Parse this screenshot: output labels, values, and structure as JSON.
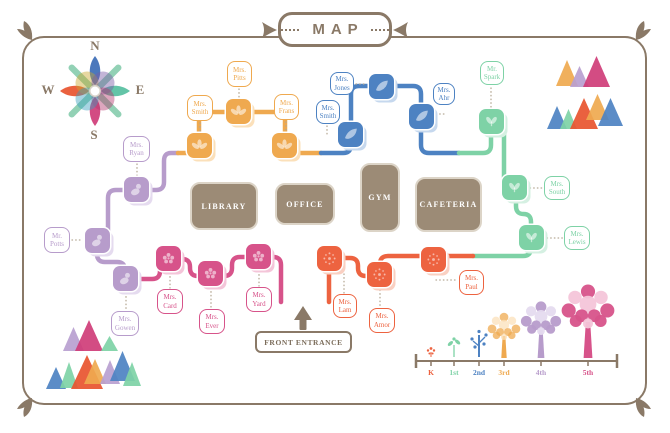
{
  "title": {
    "text": "MAP"
  },
  "compass": {
    "n": "N",
    "e": "E",
    "s": "S",
    "w": "W"
  },
  "front_entrance": {
    "label": "FRONT ENTRANCE"
  },
  "colors": {
    "frame": "#8a7967",
    "building": "#9c8b76",
    "building_border": "#dcd4c7",
    "dotted_connector": "#b5a894",
    "compass_arms": "#7fc9a8",
    "compass_petal_n": "#3c6db6",
    "compass_petal_e": "#56bfa0",
    "compass_petal_s": "#cf3d78",
    "compass_petal_w": "#e8542f"
  },
  "grades": {
    "K": {
      "color": "#ed6340",
      "light": "#fad0c2",
      "icon": "burst-icon"
    },
    "1st": {
      "color": "#7ed2a6",
      "light": "#d5f0e2",
      "icon": "sprout-icon"
    },
    "2nd": {
      "color": "#4d82c2",
      "light": "#c6d8ee",
      "icon": "leaf-icon"
    },
    "3rd": {
      "color": "#efa94f",
      "light": "#fbe0ba",
      "icon": "trefoil-icon"
    },
    "4th": {
      "color": "#b79ccb",
      "light": "#e5dbef",
      "icon": "person-icon"
    },
    "5th": {
      "color": "#d7538a",
      "light": "#f4c5d9",
      "icon": "flower-icon"
    }
  },
  "buildings": [
    {
      "id": "library",
      "label": "LIBRARY",
      "x": 190,
      "y": 182,
      "w": 68,
      "h": 48
    },
    {
      "id": "office",
      "label": "OFFICE",
      "x": 275,
      "y": 183,
      "w": 60,
      "h": 42
    },
    {
      "id": "gym",
      "label": "GYM",
      "x": 360,
      "y": 163,
      "w": 40,
      "h": 69
    },
    {
      "id": "cafeteria",
      "label": "CAFETERIA",
      "x": 415,
      "y": 177,
      "w": 67,
      "h": 55
    }
  ],
  "classrooms": [
    {
      "id": "ryan",
      "grade": "4th",
      "name": {
        "line1": "Mrs.",
        "line2": "Ryan"
      },
      "tile": {
        "x": 124,
        "y": 177
      },
      "box": {
        "x": 123,
        "y": 136,
        "w": 27,
        "h": 26
      },
      "conn": [
        137,
        164,
        137,
        176
      ]
    },
    {
      "id": "potts",
      "grade": "4th",
      "name": {
        "line1": "Mr.",
        "line2": "Potts"
      },
      "tile": {
        "x": 85,
        "y": 228
      },
      "box": {
        "x": 44,
        "y": 227,
        "w": 26,
        "h": 26
      },
      "conn": [
        72,
        240,
        83,
        240
      ]
    },
    {
      "id": "gowen",
      "grade": "4th",
      "name": {
        "line1": "Mrs.",
        "line2": "Gowen"
      },
      "tile": {
        "x": 113,
        "y": 266
      },
      "box": {
        "x": 111,
        "y": 311,
        "w": 28,
        "h": 25
      },
      "conn": [
        126,
        293,
        126,
        310
      ]
    },
    {
      "id": "card",
      "grade": "5th",
      "name": {
        "line1": "Mrs.",
        "line2": "Card"
      },
      "tile": {
        "x": 156,
        "y": 246
      },
      "box": {
        "x": 157,
        "y": 289,
        "w": 26,
        "h": 25
      },
      "conn": [
        170,
        273,
        170,
        288
      ]
    },
    {
      "id": "ever",
      "grade": "5th",
      "name": {
        "line1": "Mrs.",
        "line2": "Ever"
      },
      "tile": {
        "x": 198,
        "y": 261
      },
      "box": {
        "x": 199,
        "y": 309,
        "w": 26,
        "h": 25
      },
      "conn": [
        211,
        288,
        211,
        308
      ]
    },
    {
      "id": "yard",
      "grade": "5th",
      "name": {
        "line1": "Mrs.",
        "line2": "Yard"
      },
      "tile": {
        "x": 246,
        "y": 244
      },
      "box": {
        "x": 246,
        "y": 287,
        "w": 26,
        "h": 25
      },
      "conn": [
        259,
        271,
        259,
        286
      ]
    },
    {
      "id": "smith3",
      "grade": "3rd",
      "name": {
        "line1": "Mrs.",
        "line2": "Smith"
      },
      "tile": {
        "x": 187,
        "y": 133
      },
      "box": {
        "x": 187,
        "y": 95,
        "w": 26,
        "h": 26
      },
      "conn": [
        200,
        123,
        200,
        132
      ]
    },
    {
      "id": "pitts",
      "grade": "3rd",
      "name": {
        "line1": "Mrs.",
        "line2": "Pitts"
      },
      "tile": {
        "x": 226,
        "y": 99
      },
      "box": {
        "x": 227,
        "y": 61,
        "w": 25,
        "h": 26
      },
      "conn": [
        239,
        89,
        239,
        98
      ]
    },
    {
      "id": "frans",
      "grade": "3rd",
      "name": {
        "line1": "Mrs.",
        "line2": "Frans"
      },
      "tile": {
        "x": 272,
        "y": 133
      },
      "box": {
        "x": 274,
        "y": 94,
        "w": 25,
        "h": 26
      },
      "conn": [
        286,
        122,
        286,
        132
      ]
    },
    {
      "id": "jones",
      "grade": "2nd",
      "name": {
        "line1": "Mrs.",
        "line2": "Jones"
      },
      "tile": {
        "x": 369,
        "y": 74
      },
      "box": {
        "x": 330,
        "y": 72,
        "w": 24,
        "h": 23
      },
      "conn": [
        356,
        84,
        367,
        84
      ]
    },
    {
      "id": "smith2",
      "grade": "2nd",
      "name": {
        "line1": "Mrs.",
        "line2": "Smith"
      },
      "tile": {
        "x": 338,
        "y": 122
      },
      "box": {
        "x": 316,
        "y": 100,
        "w": 24,
        "h": 24
      },
      "conn": [
        327,
        126,
        327,
        137
      ]
    },
    {
      "id": "ahr",
      "grade": "2nd",
      "name": {
        "line1": "Mrs.",
        "line2": "Ahr"
      },
      "tile": {
        "x": 409,
        "y": 104
      },
      "box": {
        "x": 433,
        "y": 83,
        "w": 22,
        "h": 22
      },
      "conn": [
        436,
        114,
        446,
        114
      ]
    },
    {
      "id": "spark",
      "grade": "1st",
      "name": {
        "line1": "Mr.",
        "line2": "Spark"
      },
      "tile": {
        "x": 479,
        "y": 109
      },
      "box": {
        "x": 480,
        "y": 61,
        "w": 24,
        "h": 24
      },
      "conn": [
        491,
        88,
        491,
        107
      ]
    },
    {
      "id": "south",
      "grade": "1st",
      "name": {
        "line1": "Mrs.",
        "line2": "South"
      },
      "tile": {
        "x": 502,
        "y": 175
      },
      "box": {
        "x": 544,
        "y": 176,
        "w": 26,
        "h": 24
      },
      "conn": [
        530,
        188,
        543,
        188
      ]
    },
    {
      "id": "lewis",
      "grade": "1st",
      "name": {
        "line1": "Mrs.",
        "line2": "Lewis"
      },
      "tile": {
        "x": 519,
        "y": 225
      },
      "box": {
        "x": 564,
        "y": 226,
        "w": 26,
        "h": 24
      },
      "conn": [
        547,
        238,
        563,
        238
      ]
    },
    {
      "id": "lam",
      "grade": "K",
      "name": {
        "line1": "Mrs.",
        "line2": "Lam"
      },
      "tile": {
        "x": 317,
        "y": 246
      },
      "box": {
        "x": 333,
        "y": 294,
        "w": 24,
        "h": 24
      },
      "conn": [
        344,
        274,
        344,
        293
      ]
    },
    {
      "id": "amor",
      "grade": "K",
      "name": {
        "line1": "Mrs.",
        "line2": "Amor"
      },
      "tile": {
        "x": 367,
        "y": 262
      },
      "box": {
        "x": 369,
        "y": 308,
        "w": 26,
        "h": 25
      },
      "conn": [
        380,
        290,
        380,
        307
      ]
    },
    {
      "id": "paul",
      "grade": "K",
      "name": {
        "line1": "Mrs.",
        "line2": "Paul"
      },
      "tile": {
        "x": 421,
        "y": 247
      },
      "box": {
        "x": 459,
        "y": 270,
        "w": 25,
        "h": 25
      },
      "conn": [
        436,
        280,
        458,
        280
      ]
    }
  ],
  "legend": {
    "axis": {
      "x1": 416,
      "x2": 617,
      "y": 361
    },
    "items": [
      {
        "grade": "K",
        "label": "K",
        "x": 431,
        "type": "flower"
      },
      {
        "grade": "1st",
        "label": "1st",
        "x": 454,
        "type": "sprout"
      },
      {
        "grade": "2nd",
        "label": "2nd",
        "x": 479,
        "type": "sapling"
      },
      {
        "grade": "3rd",
        "label": "3rd",
        "x": 504,
        "type": "tree",
        "trunk": 22,
        "radius": 13
      },
      {
        "grade": "4th",
        "label": "4th",
        "x": 541,
        "type": "tree",
        "trunk": 28,
        "radius": 16
      },
      {
        "grade": "5th",
        "label": "5th",
        "x": 588,
        "type": "tree",
        "trunk": 36,
        "radius": 21
      }
    ]
  },
  "decorations": {
    "triangles_top_right": [
      {
        "x": 556,
        "y": 60,
        "w": 22,
        "h": 26,
        "c": "#efa94f"
      },
      {
        "x": 570,
        "y": 66,
        "w": 19,
        "h": 21,
        "c": "#b9a0d0"
      },
      {
        "x": 583,
        "y": 56,
        "w": 27,
        "h": 31,
        "c": "#cf3d78"
      },
      {
        "x": 547,
        "y": 106,
        "w": 20,
        "h": 23,
        "c": "#4d82c2"
      },
      {
        "x": 560,
        "y": 109,
        "w": 17,
        "h": 20,
        "c": "#7ed2a6"
      },
      {
        "x": 570,
        "y": 98,
        "w": 28,
        "h": 31,
        "c": "#e8542f"
      },
      {
        "x": 586,
        "y": 94,
        "w": 23,
        "h": 26,
        "c": "#efa94f"
      },
      {
        "x": 598,
        "y": 98,
        "w": 25,
        "h": 28,
        "c": "#4d82c2"
      }
    ],
    "triangles_bottom_left": [
      {
        "x": 63,
        "y": 327,
        "w": 21,
        "h": 24,
        "c": "#b9a0d0"
      },
      {
        "x": 75,
        "y": 320,
        "w": 28,
        "h": 31,
        "c": "#cf3d78"
      },
      {
        "x": 101,
        "y": 336,
        "w": 17,
        "h": 15,
        "c": "#7ed2a6"
      },
      {
        "x": 46,
        "y": 367,
        "w": 20,
        "h": 22,
        "c": "#4d82c2"
      },
      {
        "x": 60,
        "y": 362,
        "w": 18,
        "h": 26,
        "c": "#7ed2a6"
      },
      {
        "x": 71,
        "y": 355,
        "w": 32,
        "h": 34,
        "c": "#e8542f"
      },
      {
        "x": 84,
        "y": 359,
        "w": 22,
        "h": 25,
        "c": "#efa94f"
      },
      {
        "x": 100,
        "y": 360,
        "w": 20,
        "h": 24,
        "c": "#b9a0d0"
      },
      {
        "x": 110,
        "y": 351,
        "w": 25,
        "h": 30,
        "c": "#4d82c2"
      },
      {
        "x": 123,
        "y": 362,
        "w": 18,
        "h": 24,
        "c": "#7ed2a6"
      }
    ]
  }
}
